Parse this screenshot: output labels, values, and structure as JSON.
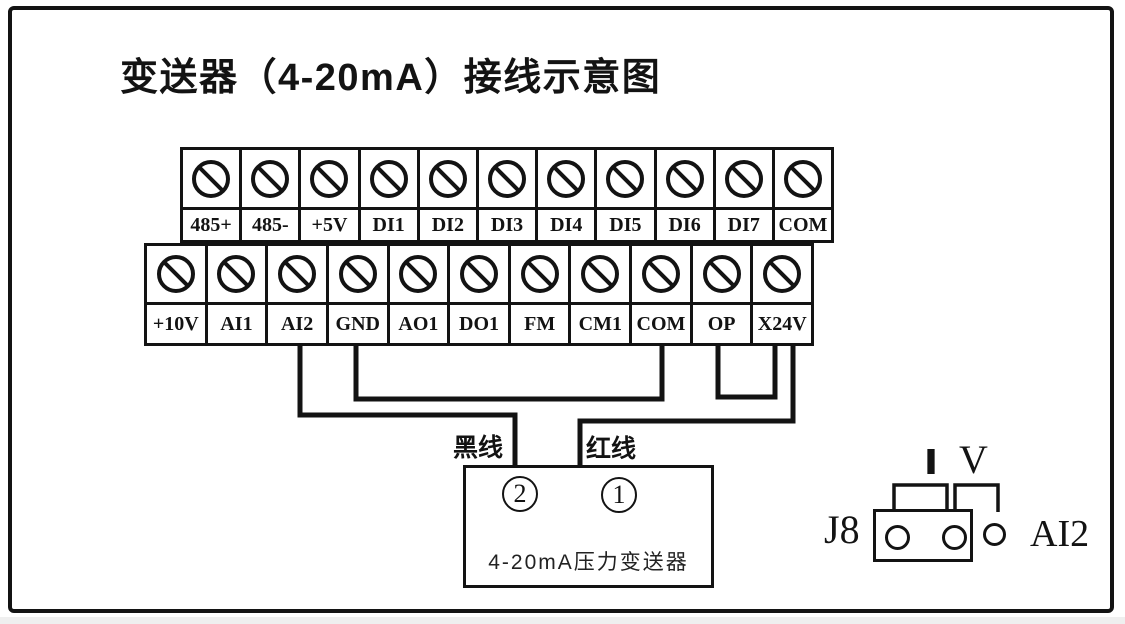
{
  "title": "变送器（4-20mA）接线示意图",
  "terminals": {
    "top": [
      "485+",
      "485-",
      "+5V",
      "DI1",
      "DI2",
      "DI3",
      "DI4",
      "DI5",
      "DI6",
      "DI7",
      "COM"
    ],
    "bottom": [
      "+10V",
      "AI1",
      "AI2",
      "GND",
      "AO1",
      "DO1",
      "FM",
      "CM1",
      "COM",
      "OP",
      "X24V"
    ]
  },
  "wiring": {
    "black_wire_label": "黑线",
    "red_wire_label": "红线",
    "connections": [
      {
        "from": "AI2",
        "to": "transmitter terminal 2",
        "wire": "黑线"
      },
      {
        "from": "GND",
        "to": "COM"
      },
      {
        "from": "OP",
        "to": "X24V"
      },
      {
        "from": "X24V",
        "to": "transmitter terminal 1",
        "wire": "红线"
      }
    ]
  },
  "transmitter": {
    "terminal_2": "2",
    "terminal_1": "1",
    "name": "4-20mA压力变送器"
  },
  "jumper": {
    "designator": "J8",
    "current_mode": "I",
    "voltage_mode": "V",
    "channel": "AI2"
  },
  "colors": {
    "line": "#131313",
    "background": "#ffffff"
  }
}
